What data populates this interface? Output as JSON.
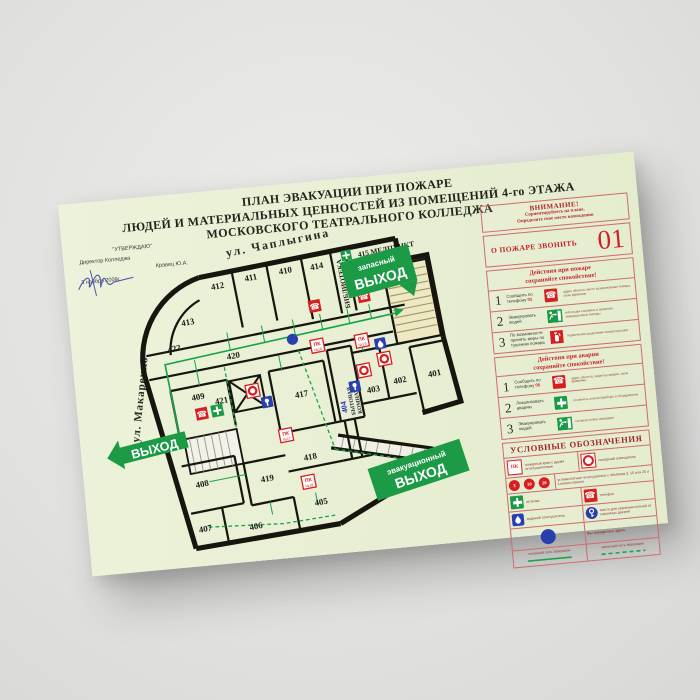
{
  "icons": {
    "phone_glyph": "☎"
  },
  "poster": {
    "title1": "ПЛАН ЭВАКУАЦИИ ПРИ ПОЖАРЕ",
    "title2": "ЛЮДЕЙ И МАТЕРИАЛЬНЫХ ЦЕННОСТЕЙ ИЗ ПОМЕЩЕНИЙ 4-го ЭТАЖА",
    "title3": "МОСКОВСКОГО ТЕАТРАЛЬНОГО КОЛЛЕДЖА"
  },
  "approval": {
    "line1": "\"УТВЕРЖДАЮ\"",
    "line2": "Директор Колледжа",
    "line3": "Кравец Ю.А.",
    "line4": "3 ноября 2009г."
  },
  "plan": {
    "street_top": "ул.  Чаплыгина",
    "street_left": "ул. Макаренко",
    "corridor": "420",
    "rooms": {
      "401": "401",
      "402": "402",
      "403": "403",
      "405": "405",
      "406": "406",
      "407": "407",
      "408": "408",
      "409": "409",
      "410": "410",
      "411": "411",
      "412": "412",
      "413": "413",
      "414": "414",
      "417": "417",
      "418": "418",
      "419": "419",
      "421": "421",
      "422": "422"
    },
    "library": "БИБЛИОТЕКА",
    "medpunkt": "415 МЕДПУНКТ",
    "room404_no": "404",
    "room404_name1": "БЫТОВАЯ",
    "room404_name2": "КОМНАТА",
    "sign_exit": "ВЫХОД",
    "sign_reserve_top": "запасный",
    "sign_reserve_bottom": "ВЫХОД",
    "sign_evac_top": "эвакуационный",
    "sign_evac_bottom": "ВЫХОД",
    "pk": "ПК",
    "pk_numbers": {
      "n16": "№16",
      "n17": "№17",
      "n18": "№18",
      "n19": "№19"
    }
  },
  "sidebar": {
    "attention": {
      "title": "ВНИМАНИЕ!",
      "line1": "Сориентируйтесь на плане.",
      "line2": "Определите свое место нахождения"
    },
    "call": {
      "label": "О ПОЖАРЕ ЗВОНИТЬ",
      "number": "01"
    },
    "fire": {
      "header1": "Действия при пожаре",
      "header2": "сохраняйте спокойствие!",
      "rows": [
        {
          "num": "1",
          "label": "Сообщить по телефону ",
          "accent": "01",
          "note": "адрес объекта, место возникновения пожара, свою фамилию"
        },
        {
          "num": "2",
          "label": "Эвакуировать людей",
          "accent": "",
          "note": "используя основные и запасные эвакуационные выходы"
        },
        {
          "num": "3",
          "label": "По возможности принять меры по тушению пожара",
          "accent": "",
          "note": "первичными средствами пожаротушения"
        }
      ]
    },
    "accident": {
      "header1": "Действия при аварии",
      "header2": "сохраняйте спокойствие!",
      "rows": [
        {
          "num": "1",
          "label": "Сообщить по телефону ",
          "accent": "05",
          "note": "адрес объекта, характер аварии, свою фамилию"
        },
        {
          "num": "2",
          "label": "Локализовать аварию",
          "accent": "",
          "note": "отключить электроприборы и оборудование"
        },
        {
          "num": "3",
          "label": "Эвакуировать людей",
          "accent": "",
          "note": "согласно плану эвакуации"
        }
      ]
    },
    "legend": {
      "title": "УСЛОВНЫЕ ОБОЗНАЧЕНИЯ",
      "pk": "пожарный кран с двумя огнетушителями",
      "detector": "пожарный извещатель",
      "co2_sizes": {
        "s1": "3",
        "s2": "10",
        "s3": "20"
      },
      "co2": "углекислотные огнетушители с объёмом 3, 10 или 20 л соответственно",
      "aid": "аптечка",
      "phone": "телефон",
      "water": "водяной огнетушитель",
      "keys": "место для хранения ключей от наружных дверей",
      "you_are_here": "Вы находитесь здесь",
      "main_path": "основной путь эвакуации",
      "reserve_path": "запасный путь эвакуации"
    }
  }
}
